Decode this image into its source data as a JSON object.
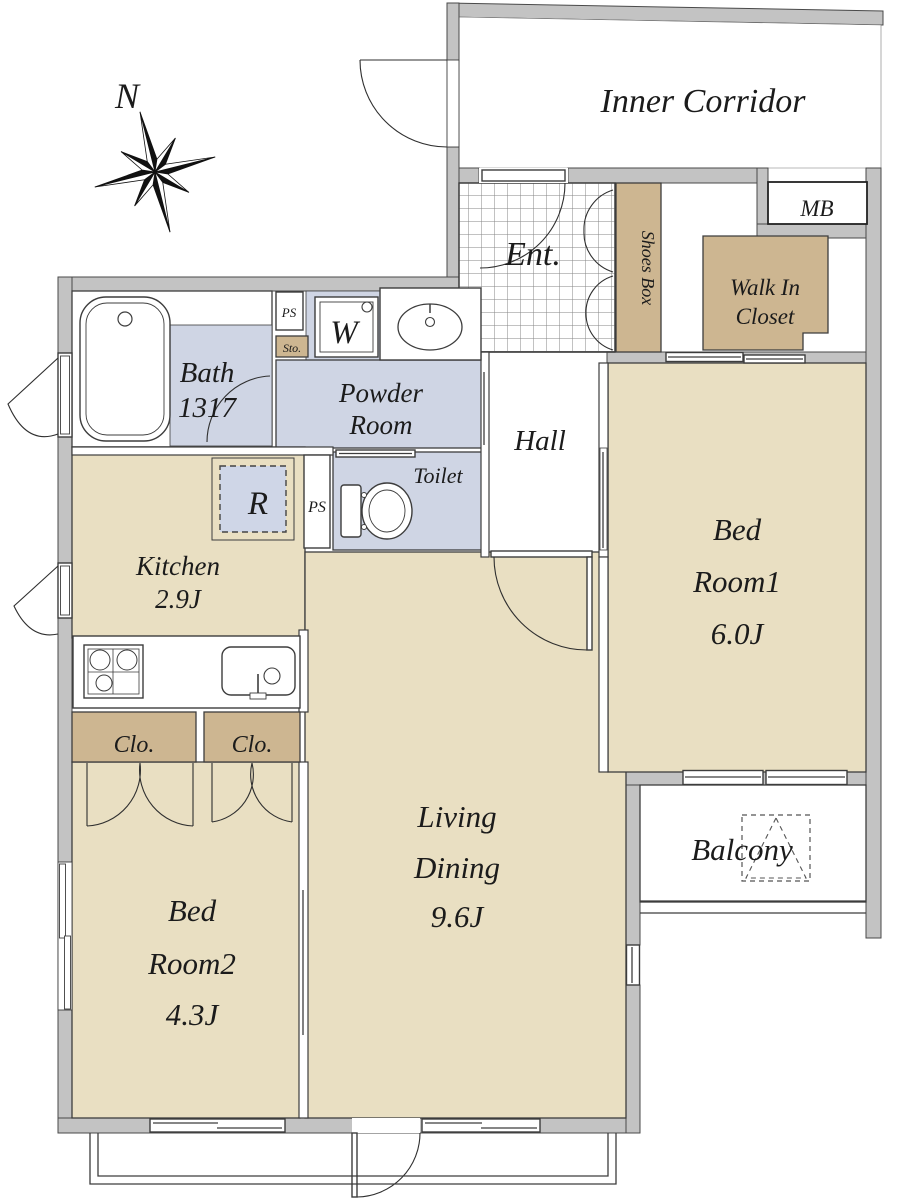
{
  "plan": {
    "compass": {
      "north": "N"
    },
    "corridor": {
      "label": "Inner Corridor"
    },
    "entrance": {
      "label": "Ent.",
      "shoes_box": "Shoes Box"
    },
    "meter_box": {
      "label": "MB"
    },
    "walk_in_closet": {
      "line1": "Walk In",
      "line2": "Closet"
    },
    "bath": {
      "line1": "Bath",
      "line2": "1317"
    },
    "powder_room": {
      "line1": "Powder",
      "line2": "Room"
    },
    "toilet": {
      "label": "Toilet"
    },
    "hall": {
      "label": "Hall"
    },
    "kitchen": {
      "line1": "Kitchen",
      "line2": "2.9J"
    },
    "bed_room1": {
      "line1": "Bed",
      "line2": "Room1",
      "line3": "6.0J"
    },
    "bed_room2": {
      "line1": "Bed",
      "line2": "Room2",
      "line3": "4.3J"
    },
    "living_dining": {
      "line1": "Living",
      "line2": "Dining",
      "line3": "9.6J"
    },
    "balcony": {
      "label": "Balcony"
    },
    "closets": {
      "left": "Clo.",
      "right": "Clo."
    },
    "labels": {
      "ps_upper": "PS",
      "ps_lower": "PS",
      "storage": "Sto.",
      "washer": "W",
      "refrigerator": "R"
    }
  },
  "colors": {
    "floor": "#e9dfc2",
    "closet": "#cdb691",
    "wet": "#cfd5e4",
    "wall": "#c3c3c3",
    "rbox": "#cfd6e7"
  }
}
